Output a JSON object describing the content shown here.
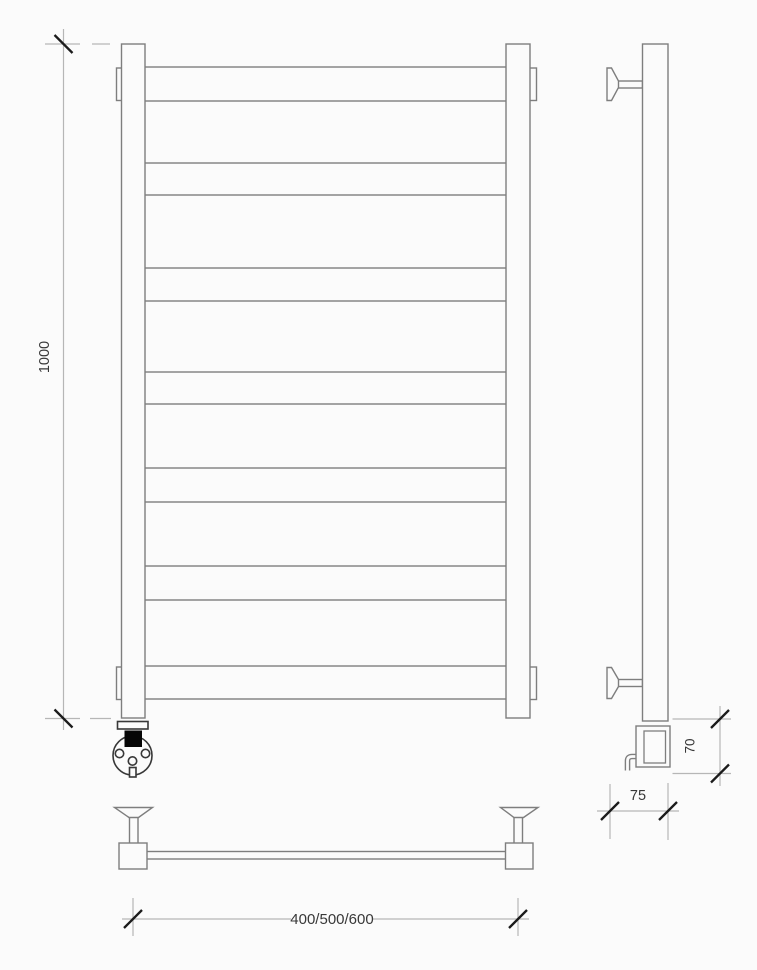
{
  "drawing": {
    "dimensions": {
      "overall_height": "1000",
      "housing_height": "70",
      "wall_depth": "75",
      "width_options": "400/500/600"
    },
    "colors": {
      "outline": "#7e7e7e",
      "dimension_line": "#b6b6b6",
      "tick": "#1b1b1b",
      "text": "#383838",
      "display_screen": "#060606",
      "background": "#fbfbfb"
    }
  }
}
